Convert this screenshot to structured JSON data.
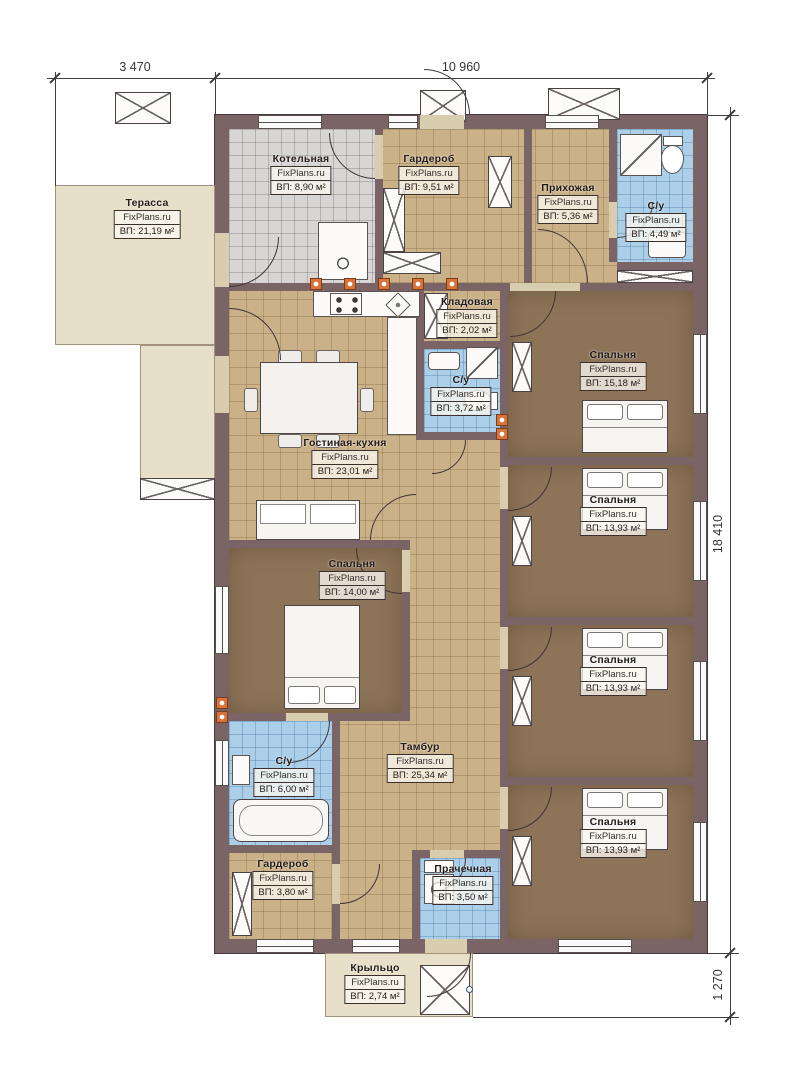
{
  "watermark": "FixPlans.ru",
  "dimensions": {
    "terrace_width": "3 470",
    "house_width": "10 960",
    "house_depth": "18 410",
    "porch_depth": "1 270"
  },
  "rooms": {
    "terrace": {
      "name": "Терасса",
      "area": "ВП: 21,19 м²"
    },
    "boiler": {
      "name": "Котельная",
      "area": "ВП: 8,90 м²"
    },
    "wardrobe_top": {
      "name": "Гардероб",
      "area": "ВП: 9,51 м²"
    },
    "hallway": {
      "name": "Прихожая",
      "area": "ВП: 5,36 м²"
    },
    "bath_top": {
      "name": "С/у",
      "area": "ВП: 4,49 м²"
    },
    "pantry": {
      "name": "Кладовая",
      "area": "ВП: 2,02 м²"
    },
    "bath_mid": {
      "name": "С/у",
      "area": "ВП: 3,72 м²"
    },
    "living_kitchen": {
      "name": "Гостиная-кухня",
      "area": "ВП: 23,01 м²"
    },
    "bedroom_1": {
      "name": "Спальня",
      "area": "ВП: 15,18 м²"
    },
    "bedroom_2": {
      "name": "Спальня",
      "area": "ВП: 13,93 м²"
    },
    "bedroom_3": {
      "name": "Спальня",
      "area": "ВП: 13,93 м²"
    },
    "bedroom_4": {
      "name": "Спальня",
      "area": "ВП: 13,93 м²"
    },
    "bedroom_left": {
      "name": "Спальня",
      "area": "ВП: 14,00 м²"
    },
    "bath_bottom": {
      "name": "С/у",
      "area": "ВП: 6,00 м²"
    },
    "tambour": {
      "name": "Тамбур",
      "area": "ВП: 25,34 м²"
    },
    "wardrobe_bottom": {
      "name": "Гардероб",
      "area": "ВП: 3,80 м²"
    },
    "laundry": {
      "name": "Прачечная",
      "area": "ВП: 3,50 м²"
    },
    "porch": {
      "name": "Крыльцо",
      "area": "ВП: 2,74 м²"
    }
  },
  "colors": {
    "wall": "#7b6466",
    "floor_tile_tan": "#cbb188",
    "floor_tile_grey": "#d8d6d5",
    "floor_tile_blue": "#abcfe9",
    "carpet_brown": "#8d7458",
    "outdoor_beige": "#e8dfc9",
    "accent_orange": "#d8733b"
  }
}
